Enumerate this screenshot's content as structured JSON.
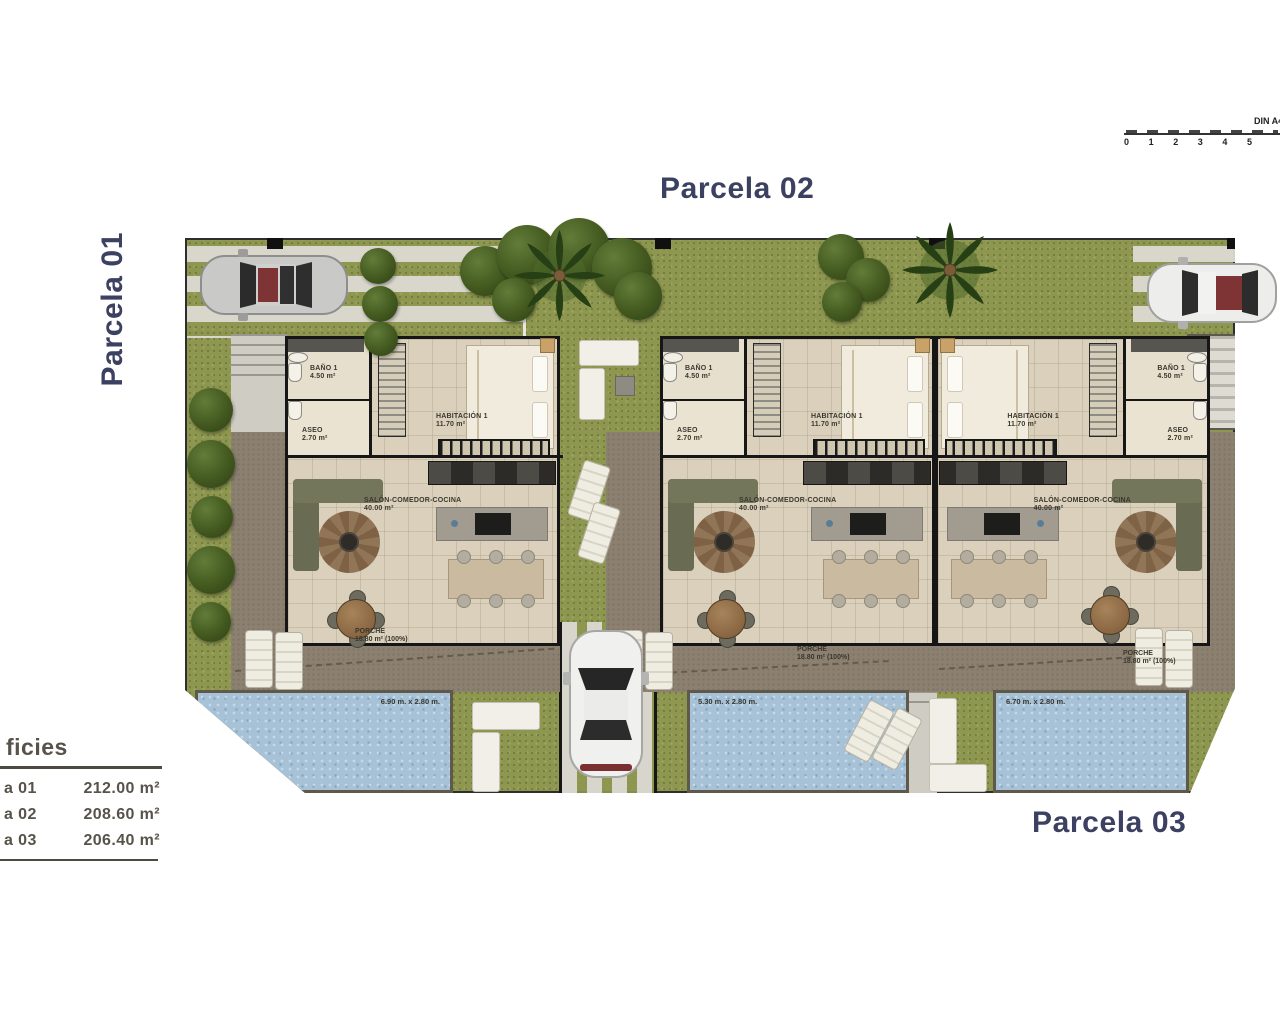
{
  "titles": {
    "parcela_01": "Parcela 01",
    "parcela_02": "Parcela 02",
    "parcela_03": "Parcela 03"
  },
  "scale_bar": {
    "label": "DIN A4",
    "ticks": [
      "0",
      "1",
      "2",
      "3",
      "4",
      "5"
    ]
  },
  "legend": {
    "title": "ficies",
    "rows": [
      {
        "label": "a 01",
        "value": "212.00 m²"
      },
      {
        "label": "a 02",
        "value": "208.60 m²"
      },
      {
        "label": "a 03",
        "value": "206.40 m²"
      }
    ]
  },
  "villas": [
    {
      "bano_label": "BAÑO 1",
      "bano_area": "4.50 m²",
      "aseo_label": "ASEO",
      "aseo_area": "2.70 m²",
      "habitacion_label": "HABITACIÓN 1",
      "habitacion_area": "11.70 m²",
      "salon_label": "SALÓN-COMEDOR-COCINA",
      "salon_area": "40.00 m²",
      "porche_label": "PORCHE",
      "porche_area": "18.80 m² (100%)",
      "pool_dimensions": "6.90 m. x 2.80 m."
    },
    {
      "bano_label": "BAÑO 1",
      "bano_area": "4.50 m²",
      "aseo_label": "ASEO",
      "aseo_area": "2.70 m²",
      "habitacion_label": "HABITACIÓN 1",
      "habitacion_area": "11.70 m²",
      "salon_label": "SALÓN-COMEDOR-COCINA",
      "salon_area": "40.00 m²",
      "porche_label": "PORCHE",
      "porche_area": "18.80 m² (100%)",
      "pool_dimensions": "5.30 m. x 2.80 m."
    },
    {
      "bano_label": "BAÑO 1",
      "bano_area": "4.50 m²",
      "aseo_label": "ASEO",
      "aseo_area": "2.70 m²",
      "habitacion_label": "HABITACIÓN 1",
      "habitacion_area": "11.70 m²",
      "salon_label": "SALÓN-COMEDOR-COCINA",
      "salon_area": "40.00 m²",
      "porche_label": "PORCHE",
      "porche_area": "18.80 m² (100%)",
      "pool_dimensions": "6.70 m. x 2.80 m."
    }
  ],
  "colors": {
    "title": "#3c4161",
    "legend_text": "#57534b",
    "grass": "#8e9750",
    "terrace": "#8c8170",
    "pool_water": "#a7c1d6",
    "floor": "#dad0bc",
    "wall": "#161616"
  }
}
